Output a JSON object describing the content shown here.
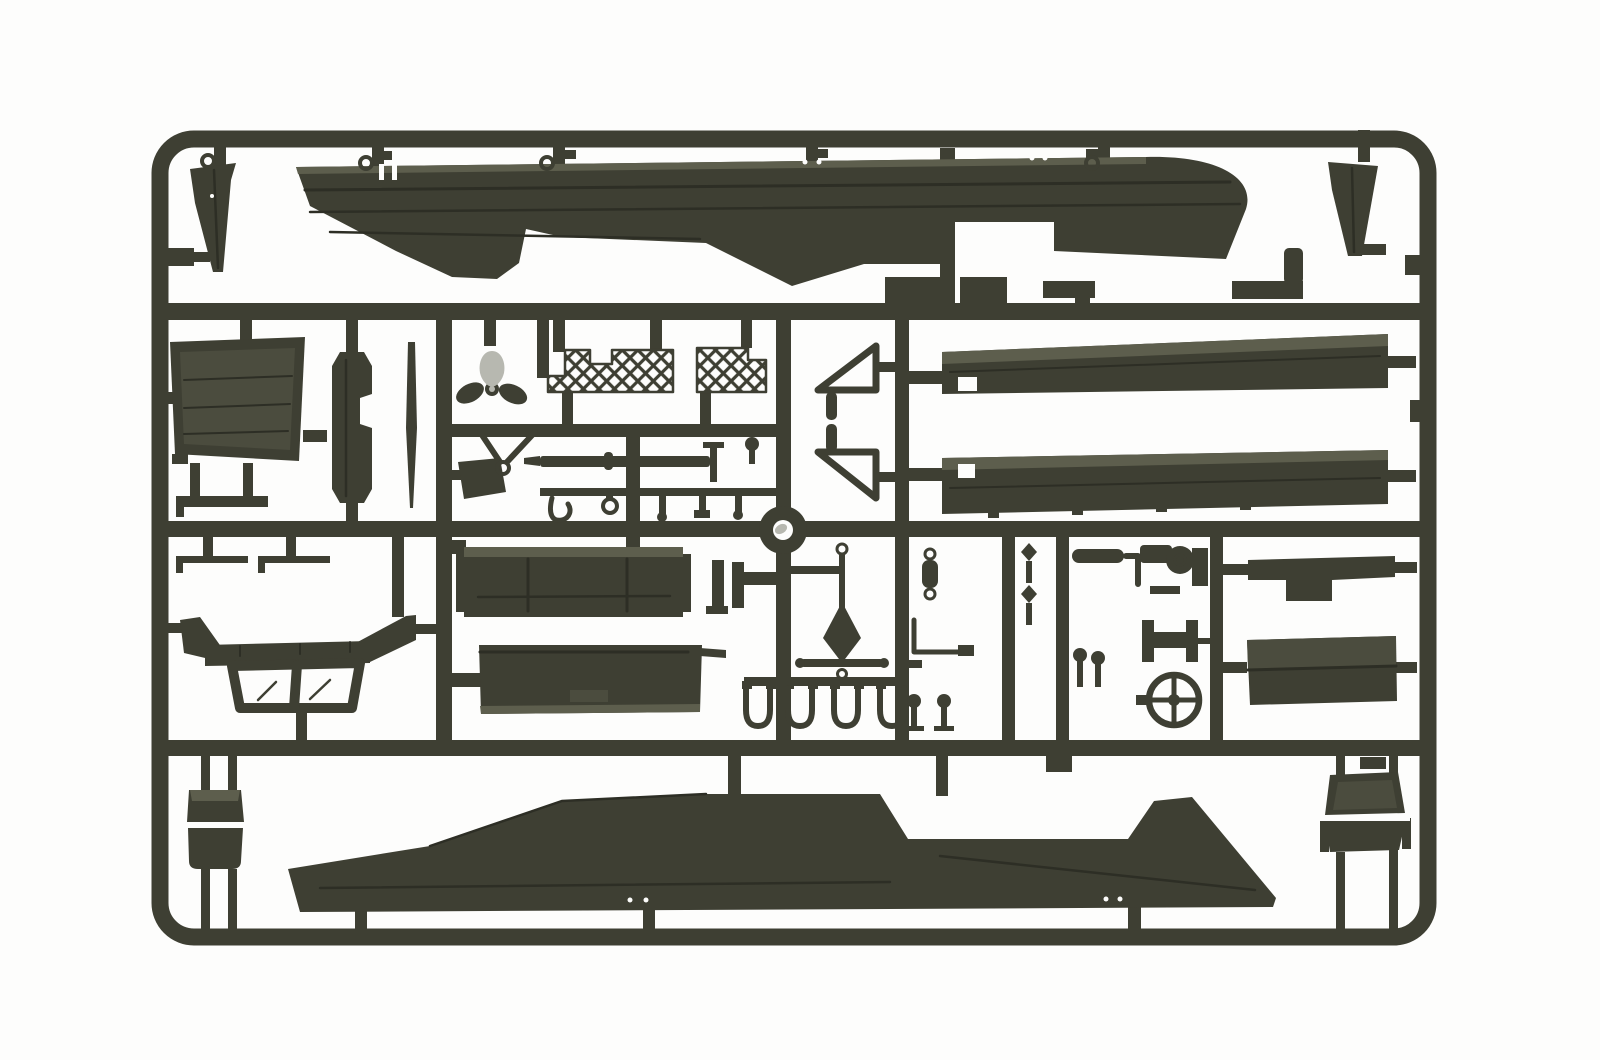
{
  "image": {
    "alt": "Photograph of an injection-moulded plastic model kit sprue in dark olive drab plastic on a white background. The rectangular runner frame holds two long boat-hull side panels (top and bottom), two deck planks, two bow cones, a three-blade propeller, mesh grille panels, a windshield frame, two seats, a steering wheel, fender panels, equipment trays and many small pins, hooks, levers and stirrup fittings.",
    "type": "photograph",
    "subject": "model kit sprue with olive drab parts"
  },
  "palette": {
    "background": "#fdfdfc",
    "plastic": "#3e3f33",
    "plastic_dark": "#2d2e25",
    "plastic_mid": "#4b4c3e",
    "plastic_light": "#5d5e4d",
    "metal_highlight": "#b7b8b0"
  },
  "parts": {
    "frame": {
      "label": "Sprue runner frame"
    },
    "upper_hull": {
      "label": "Hull side panel (upper)"
    },
    "lower_hull": {
      "label": "Hull side panel (lower)"
    },
    "bow_cone_left": {
      "label": "Bow end cone (left)"
    },
    "bow_cone_right": {
      "label": "Bow end cone (right)"
    },
    "radiator_panel": {
      "label": "Radiator / floor panel"
    },
    "suspension_spindle": {
      "label": "Suspension spindle"
    },
    "thin_rod": {
      "label": "Thin rod / barrel"
    },
    "propeller": {
      "label": "Three-blade propeller"
    },
    "mesh_grille_left": {
      "label": "Mesh grille panel (left)"
    },
    "mesh_grille_right": {
      "label": "Mesh grille panel (right)"
    },
    "triangle_upper": {
      "label": "Triangular bracket (upper)"
    },
    "triangle_lower": {
      "label": "Triangular bracket (lower)"
    },
    "deck_plank_upper": {
      "label": "Deck plank (upper)"
    },
    "deck_plank_lower": {
      "label": "Deck plank (lower)"
    },
    "stowage_bars": {
      "label": "Stowage bars and step brackets"
    },
    "fender_upper": {
      "label": "Fender panel (upper)"
    },
    "fender_lower": {
      "label": "Fender panel (lower)"
    },
    "pulley_wheel": {
      "label": "Pulley wheel"
    },
    "anchor_rod": {
      "label": "Anchor rod with crossbar"
    },
    "windshield": {
      "label": "Windshield frame"
    },
    "driver_seat": {
      "label": "Seat (left)"
    },
    "crew_seat": {
      "label": "Seat (right)"
    },
    "box_tray_upper": {
      "label": "Equipment tray (upper)"
    },
    "box_tray_lower": {
      "label": "Equipment tray (lower)"
    },
    "engine_block": {
      "label": "Engine assembly"
    },
    "winch_drum": {
      "label": "Winch drum"
    },
    "steering_wheel": {
      "label": "Steering wheel"
    },
    "gun_barrel": {
      "label": "Barrel with tee handle"
    },
    "y_link": {
      "label": "Y-shaped link"
    },
    "wedge_flap": {
      "label": "Wedge flap"
    },
    "footstep": {
      "label": "Foot step bracket"
    },
    "grab_rods": {
      "label": "Grab handle rods"
    },
    "small_fittings": {
      "label": "Small fittings: pins, hooks, stirrups, levers"
    }
  }
}
